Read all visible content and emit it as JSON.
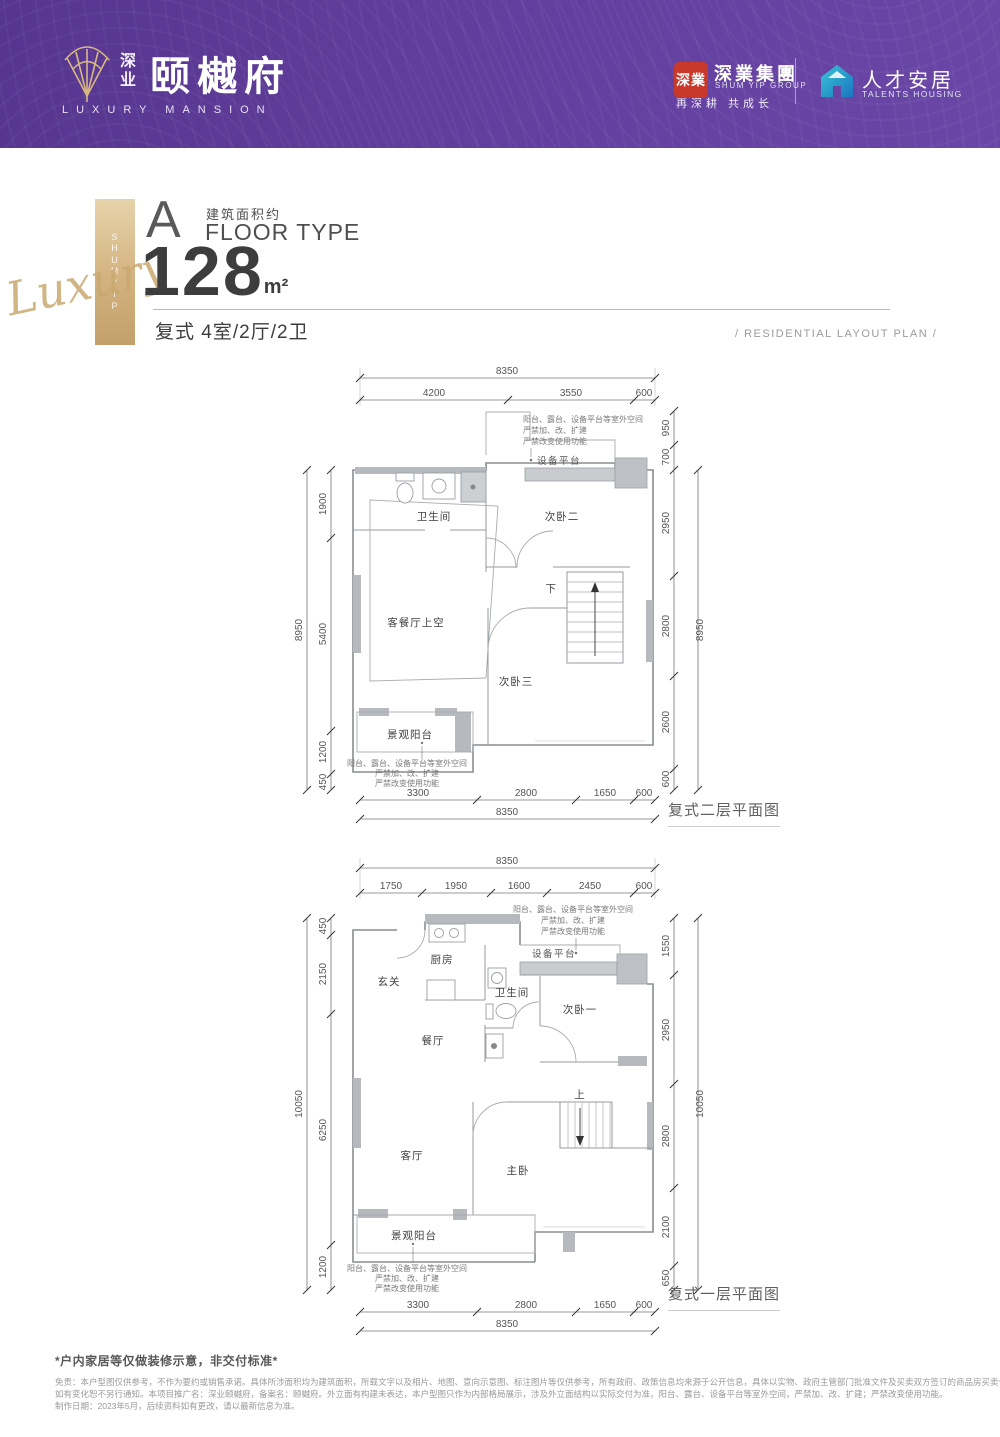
{
  "header": {
    "brand_cn_top": "深",
    "brand_cn_bottom": "业",
    "brand_large": "颐樾府",
    "brand_en": "LUXURY MANSION",
    "seal_text": "深業",
    "group_cn": "深業集團",
    "group_en": "SHUM YIP GROUP",
    "group_slogan": "再深耕  共成长",
    "talents_cn": "人才安居",
    "talents_en": "TALENTS HOUSING"
  },
  "intro": {
    "type_letter": "A",
    "area_approx_label": "建筑面积约",
    "floor_type_label": "FLOOR TYPE",
    "area_value": "128",
    "area_unit": "m²",
    "layout_text": "复式 4室/2厅/2卫",
    "side_bar_text": "SHUMYIP",
    "script_text": "Luxury",
    "plan_tag": "/  RESIDENTIAL LAYOUT PLAN  /"
  },
  "annotations": {
    "outdoor_l1": "阳台、露台、设备平台等室外空间",
    "outdoor_l2": "严禁加、改、扩建",
    "outdoor_l3": "严禁改变使用功能",
    "equipment": "设备平台"
  },
  "upper_plan": {
    "caption": "复式二层平面图",
    "rooms": {
      "bath": "卫生间",
      "bed2": "次卧二",
      "living_void": "客餐厅上空",
      "bed3": "次卧三",
      "balcony": "景观阳台",
      "down": "下"
    },
    "dims": {
      "top_total": "8350",
      "top": [
        "4200",
        "3550",
        "600"
      ],
      "left_total": "8950",
      "left": [
        "1900",
        "5400",
        "1200",
        "450"
      ],
      "right": [
        "950",
        "700",
        "2950",
        "2800",
        "2600",
        "600"
      ],
      "right_total": "8950",
      "bottom": [
        "3300",
        "2800",
        "1650",
        "600"
      ],
      "bottom_total": "8350"
    }
  },
  "lower_plan": {
    "caption": "复式一层平面图",
    "rooms": {
      "foyer": "玄关",
      "kitchen": "厨房",
      "bath": "卫生间",
      "bed1": "次卧一",
      "dining": "餐厅",
      "up": "上",
      "living": "客厅",
      "master": "主卧",
      "balcony": "景观阳台"
    },
    "dims": {
      "top_total": "8350",
      "top": [
        "1750",
        "1950",
        "1600",
        "2450",
        "600"
      ],
      "left_total": "10050",
      "left": [
        "450",
        "2150",
        "6250",
        "1200"
      ],
      "right": [
        "1550",
        "2950",
        "2800",
        "2100",
        "650"
      ],
      "right_total": "10050",
      "bottom": [
        "3300",
        "2800",
        "1650",
        "600"
      ],
      "bottom_total": "8350"
    }
  },
  "footer": {
    "note": "*户内家居等仅做装修示意，非交付标准*",
    "disclaimer_l1": "免责：本户型图仅供参考，不作为要约或销售承诺。具体所涉面积均为建筑面积，所载文字以及相片、地图、意向示意图、标注图片等仅供参考，所有政府、政策信息均来源于公开信息，具体以实物、政府主管部门批准文件及买卖双方签订的商品房买卖合同约定为准，",
    "disclaimer_l2": "如有变化恕不另行通知。本项目推广名：深业颐樾府，备案名：颐樾府。外立面有构建未表达，本户型图只作为内部格局展示，涉及外立面结构以实际交付为准，阳台、露台、设备平台等室外空间，严禁加、改、扩建；严禁改变使用功能。",
    "disclaimer_l3": "制作日期：2023年5月，后续资料如有更改，请以最新信息为准。"
  }
}
